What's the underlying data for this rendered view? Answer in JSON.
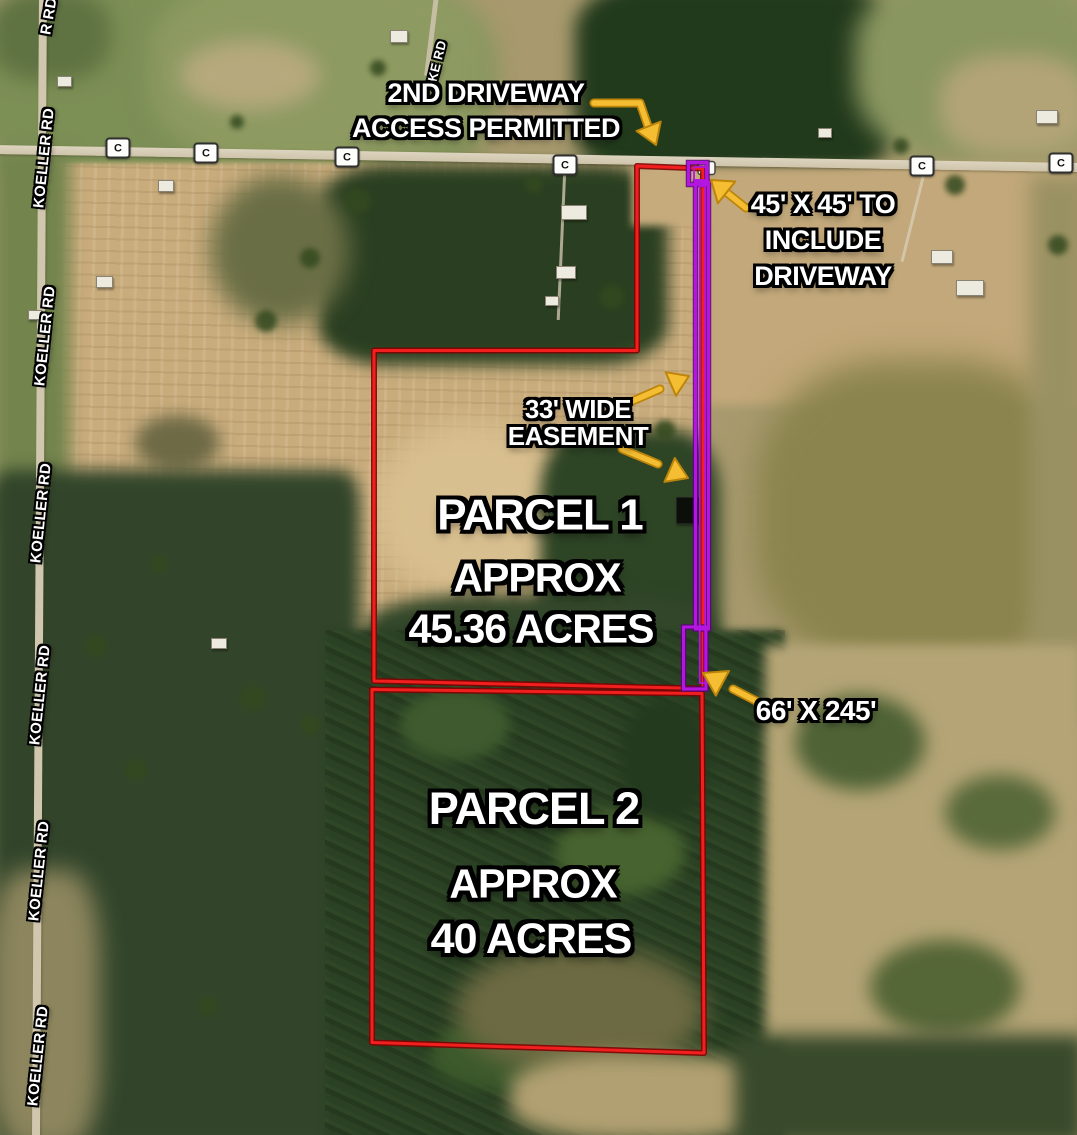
{
  "parcels": [
    {
      "title": "PARCEL 1",
      "approx": "APPROX",
      "acreage": "45.36 ACRES"
    },
    {
      "title": "PARCEL 2",
      "approx": "APPROX",
      "acreage": "40 ACRES"
    }
  ],
  "callouts": {
    "second_driveway": {
      "line1": "2ND DRIVEWAY",
      "line2": "ACCESS PERMITTED"
    },
    "driveway_square": {
      "line1": "45' X 45' TO",
      "line2": "INCLUDE",
      "line3": "DRIVEWAY"
    },
    "easement": {
      "line1": "33' WIDE",
      "line2": "EASEMENT"
    },
    "access_strip": {
      "label": "66' X 245'"
    }
  },
  "roads": {
    "koeller_rd": "KOELLER RD",
    "koeller_rd_partial": "R RD",
    "ke_rd": "KE RD",
    "county_marker": "C"
  },
  "colors": {
    "parcel_boundary": "#f21f1f",
    "easement_boundary": "#b316de",
    "arrow": "#f4bd32"
  }
}
